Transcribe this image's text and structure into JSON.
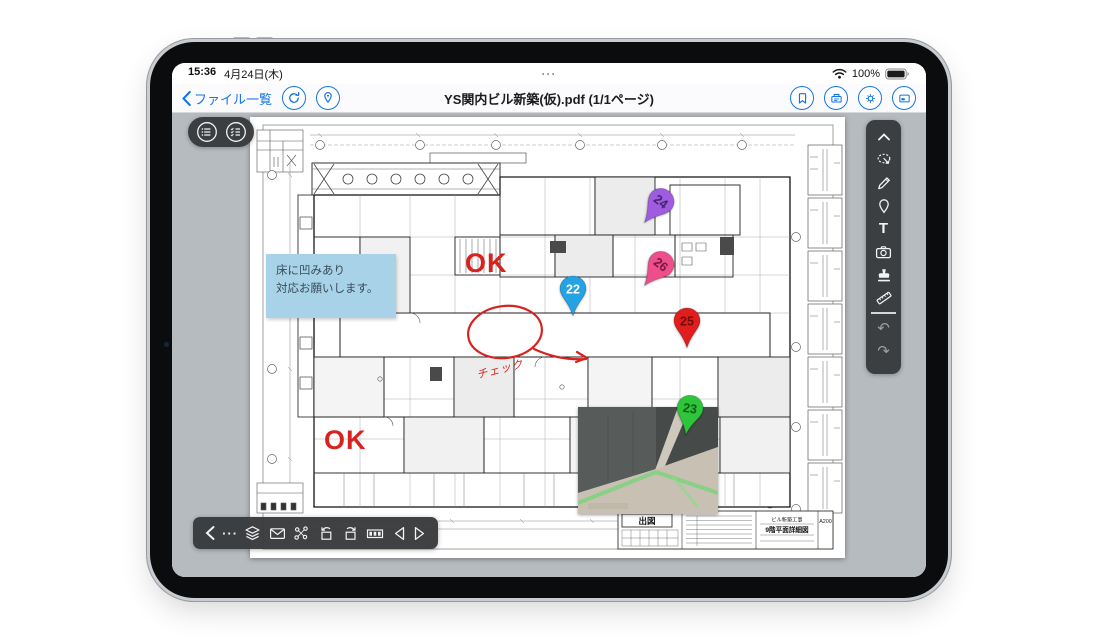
{
  "status": {
    "time": "15:36",
    "date": "4月24日(木)",
    "multitask": "···",
    "battery": "100%"
  },
  "navbar": {
    "back_label": "ファイル一覧",
    "title": "YS関内ビル新築(仮).pdf (1/1ページ)",
    "accent_color": "#1474e4"
  },
  "annotations": {
    "note": {
      "line1": "床に凹みあり",
      "line2": "対応お願いします。",
      "bg_color": "#a7d2e8"
    },
    "ok_top": "OK",
    "ok_bottom": "OK",
    "check_label": "チェック",
    "ink_color": "#d6231f",
    "pins": [
      {
        "number": "24",
        "color": "#a05ce0",
        "text_color": "#41246e"
      },
      {
        "number": "26",
        "color": "#ee4e8b",
        "text_color": "#76163c"
      },
      {
        "number": "22",
        "color": "#24a3e4",
        "text_color": "#ffffff"
      },
      {
        "number": "25",
        "color": "#e21d1d",
        "text_color": "#6e0f0f"
      },
      {
        "number": "23",
        "color": "#2dc53a",
        "text_color": "#0f5c18"
      }
    ]
  },
  "drawing": {
    "titleblock": {
      "stamp": "出図",
      "project": "ビル新築工事",
      "sheet_title": "9階平面詳細図",
      "sheet_no": "A200"
    }
  },
  "palette": {
    "text_tool": "T",
    "undo": "↶",
    "redo": "↷"
  },
  "bottombar": {
    "more": "···"
  },
  "theme": {
    "toolbar_dark": "#37393b",
    "content_bg": "#b6bbc0"
  }
}
